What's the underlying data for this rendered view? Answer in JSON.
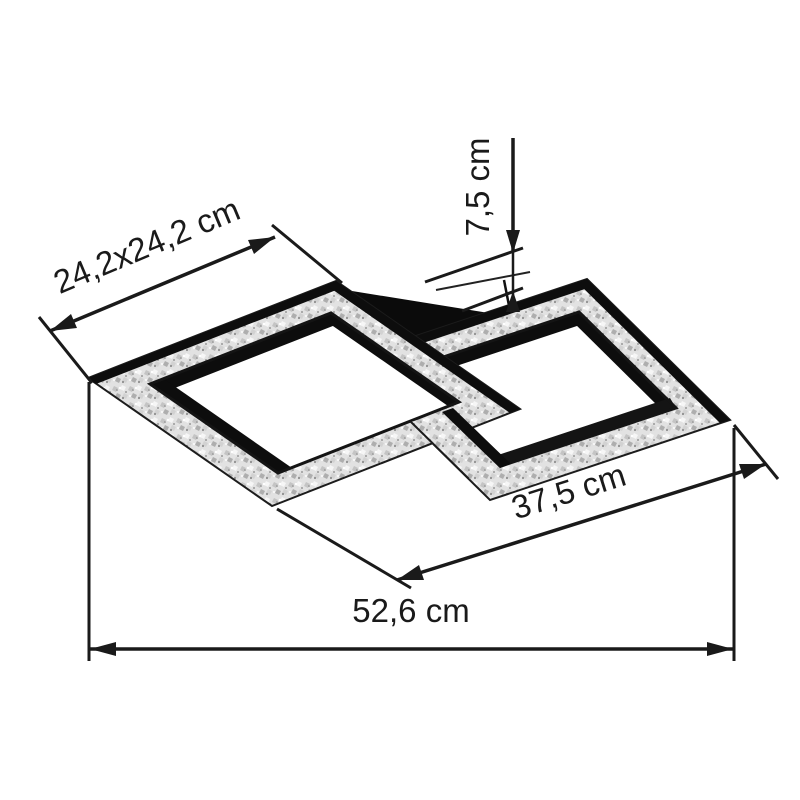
{
  "diagram": {
    "title": "Ceiling light dimension diagram",
    "product": "LED ceiling light with two interlocking square crystal frames and central black canopy",
    "background_color": "#ffffff",
    "annotation_color": "#1a1a1a",
    "lamp_colors": {
      "frame_black": "#0d0d0d",
      "crystal_band": "#e2e2e2",
      "canopy_black": "#0b0b0b"
    },
    "dimensions": {
      "frame_size": {
        "label": "24,2x24,2 cm",
        "meaning": "square frame size"
      },
      "height": {
        "label": "7,5 cm",
        "meaning": "height from ceiling plate to frame plane"
      },
      "inner_span": {
        "label": "37,5 cm",
        "meaning": "diagonal span across lower right"
      },
      "total_width": {
        "label": "52,6 cm",
        "meaning": "total width"
      }
    }
  }
}
